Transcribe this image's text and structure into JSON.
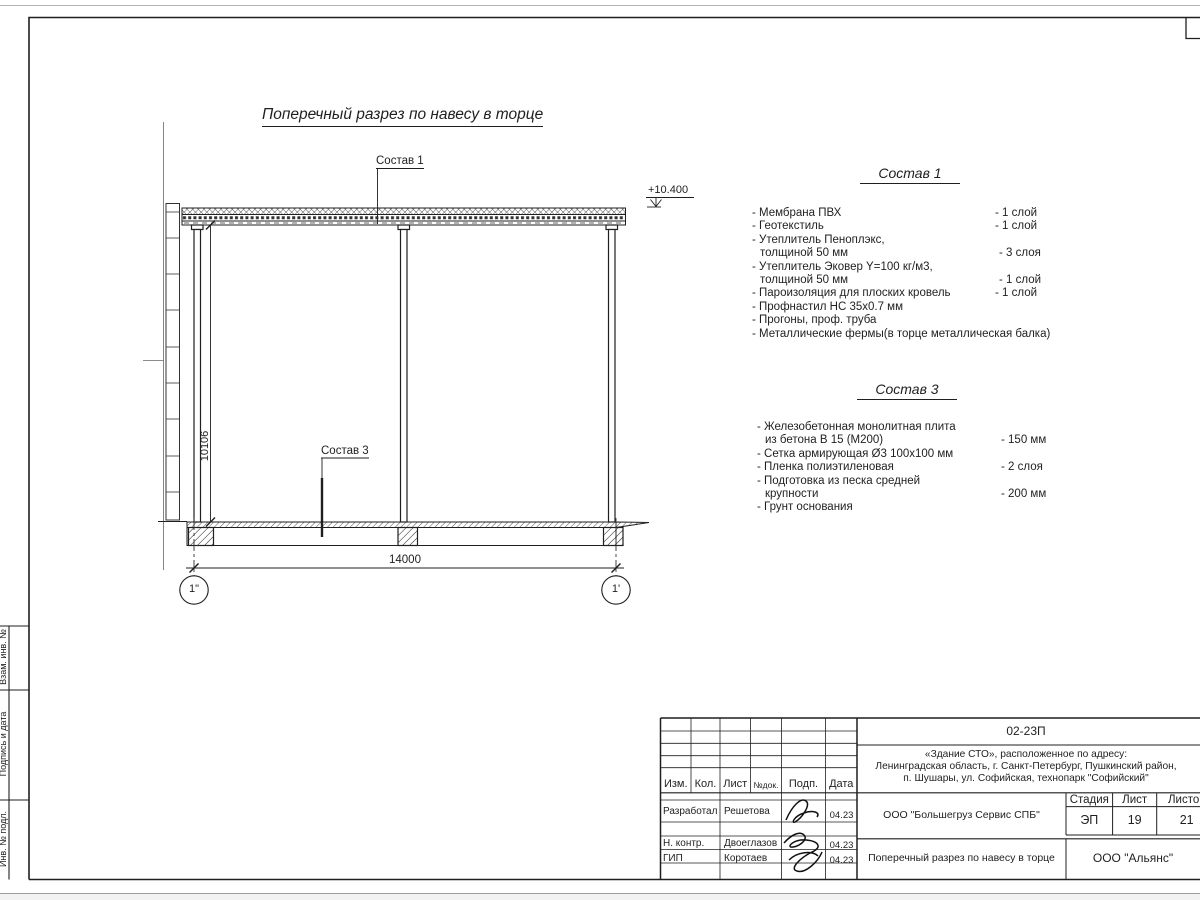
{
  "colors": {
    "ink": "#1f1f1f",
    "paper": "#ffffff",
    "sheet_edge": "#a8a8a8"
  },
  "drawing": {
    "title": "Поперечный разрез по навесу в торце",
    "leader1": "Состав 1",
    "leader3": "Состав 3",
    "elevation": "+10.400",
    "width_dim": "14000",
    "height_dim": "10106",
    "axis_left": "1\"",
    "axis_right": "1'"
  },
  "spec1": {
    "heading": "Состав 1",
    "lines": [
      {
        "t": "- Мембрана ПВХ",
        "v": "- 1 слой"
      },
      {
        "t": "- Геотекстиль",
        "v": "- 1 слой"
      },
      {
        "t": "- Утеплитель Пеноплэкс,",
        "v": ""
      },
      {
        "t": "толщиной 50 мм",
        "v": "- 3 слоя"
      },
      {
        "t": "- Утеплитель Эковер Y=100 кг/м3,",
        "v": ""
      },
      {
        "t": "толщиной 50 мм",
        "v": "- 1 слой"
      },
      {
        "t": "- Пароизоляция для плоских кровель",
        "v": "- 1 слой"
      },
      {
        "t": "- Профнастил НС 35х0.7 мм",
        "v": ""
      },
      {
        "t": "- Прогоны, проф. труба",
        "v": ""
      },
      {
        "t": "- Металлические фермы(в торце металлическая балка)",
        "v": ""
      }
    ]
  },
  "spec3": {
    "heading": "Состав 3",
    "lines": [
      {
        "t": "- Железобетонная  монолитная плита",
        "v": ""
      },
      {
        "t": "из бетона В 15 (М200)",
        "v": "- 150 мм"
      },
      {
        "t": "- Сетка армирующая Ø3 100х100 мм",
        "v": ""
      },
      {
        "t": "- Пленка полиэтиленовая",
        "v": "-  2 слоя"
      },
      {
        "t": "- Подготовка из песка средней",
        "v": ""
      },
      {
        "t": "крупности",
        "v": "- 200 мм"
      },
      {
        "t": "- Грунт основания",
        "v": ""
      }
    ]
  },
  "titleblock": {
    "doc_number": "02-23П",
    "project_lines": [
      "«Здание СТО», расположенное по адресу:",
      "Ленинградская область, г. Санкт-Петербург, Пушкинский район,",
      "п. Шушары, ул. Софийская, технопарк \"Софийский\""
    ],
    "customer": "ООО \"Большегруз Сервис СПБ\"",
    "sheet_title": "Поперечный разрез по навесу в торце",
    "company": "ООО \"Альянс\"",
    "stage_label": "Стадия",
    "sheet_label": "Лист",
    "sheets_label": "Листов",
    "stage": "ЭП",
    "sheet": "19",
    "sheets": "21",
    "header_cells": [
      "Изм.",
      "Кол.",
      "Лист",
      "№док.",
      "Подп.",
      "Дата"
    ],
    "rows": [
      {
        "role": "Разработал",
        "name": "Решетова",
        "date": "04.23"
      },
      {
        "role": "Н. контр.",
        "name": "Двоеглазов",
        "date": "04.23"
      },
      {
        "role": "ГИП",
        "name": "Коротаев",
        "date": "04.23"
      }
    ]
  },
  "side_stamp": {
    "labels": [
      "Взам. инв. №",
      "Подпись и дата",
      "Инв. № подл."
    ]
  }
}
